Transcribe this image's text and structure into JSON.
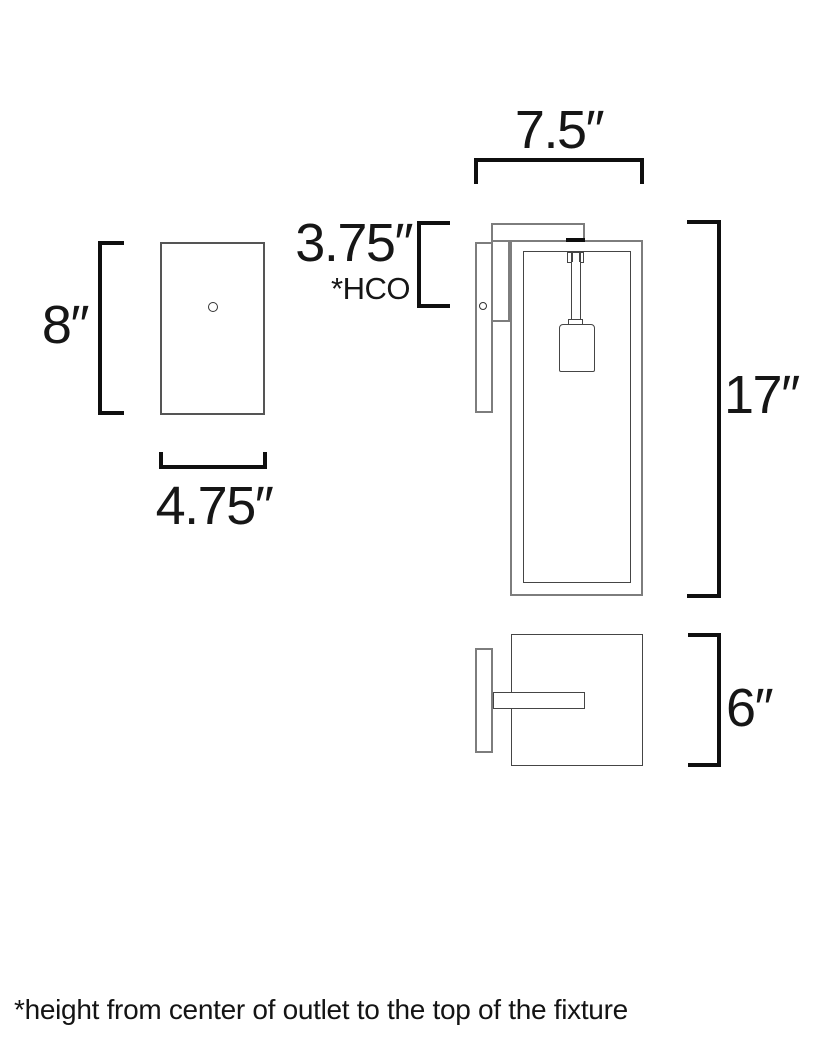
{
  "front_view": {
    "height_label": "8″",
    "width_label": "4.75″"
  },
  "side_view": {
    "top_width_label": "7.5″",
    "hco_value_label": "3.75″",
    "hco_note_label": "*HCO",
    "height_label": "17″"
  },
  "top_view": {
    "depth_label": "6″"
  },
  "footnote": "*height from center of outlet to the top of the fixture",
  "colors": {
    "background": "#ffffff",
    "outline_gray": "#7d7d7d",
    "outline_dark": "#454545",
    "dimension_black": "#0f0f0f",
    "text_black": "#161616"
  }
}
